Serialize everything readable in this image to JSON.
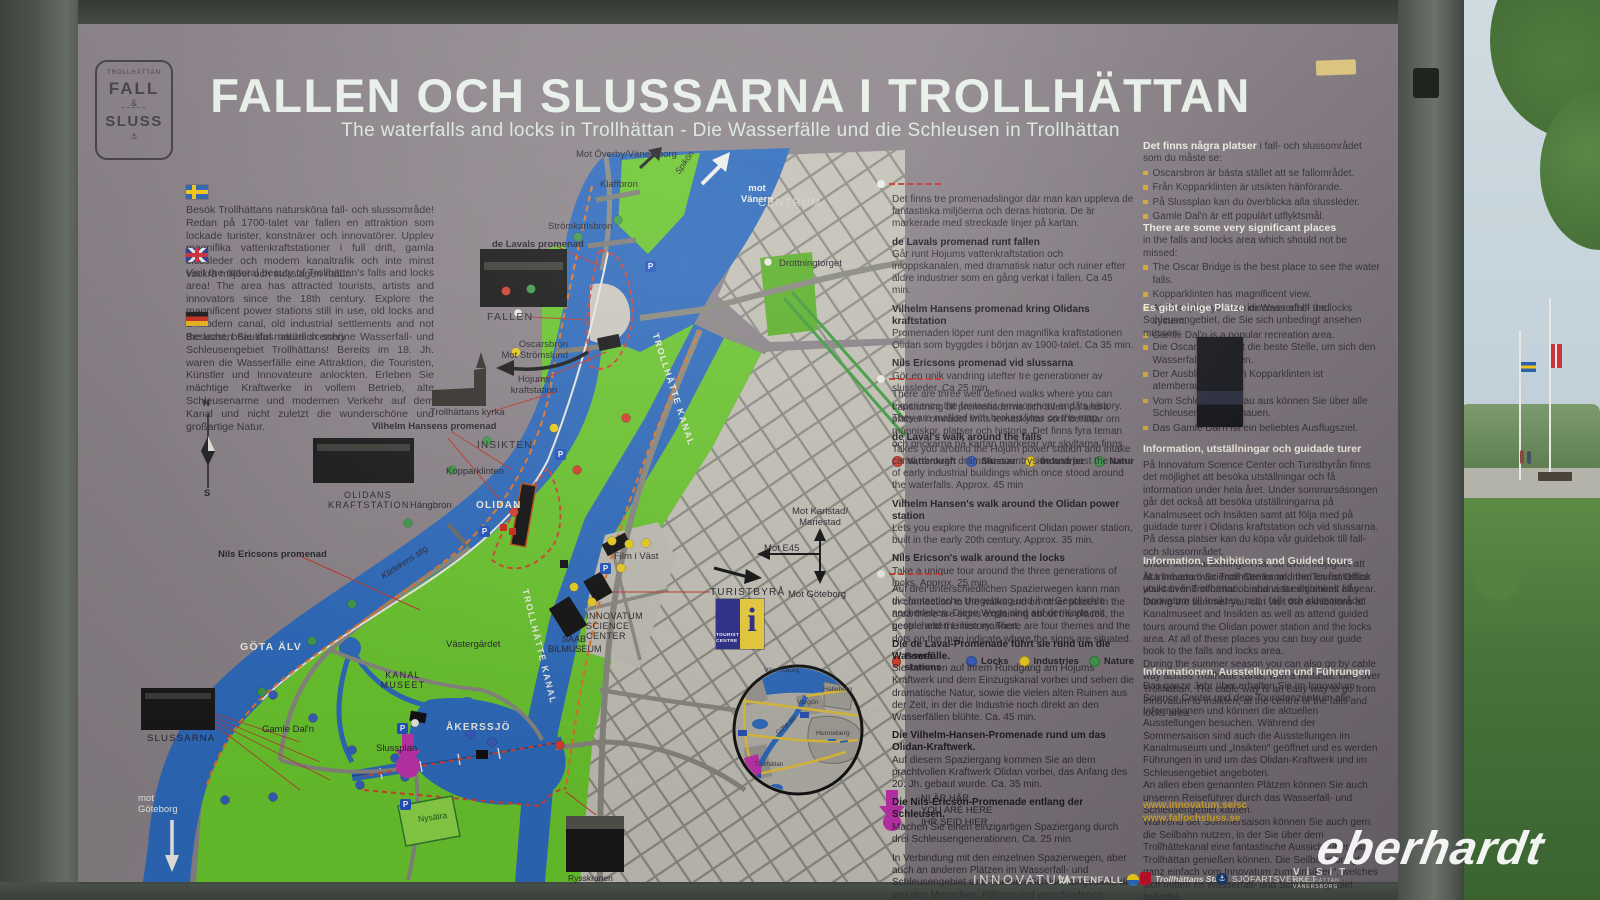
{
  "scene": {
    "watermark": "eberhardt"
  },
  "board": {
    "logo": {
      "arc": "TROLLHÄTTAN",
      "fall": "FALL",
      "amp": "&",
      "sluss": "SLUSS",
      "anchor": "⚓"
    },
    "title": "FALLEN OCH SLUSSARNA I TROLLHÄTTAN",
    "subtitle": "The waterfalls and locks in Trollhättan - Die Wasserfälle und die Schleusen in Trollhättan"
  },
  "intro": {
    "sv": "Besök Trollhättans natursköna fall- och slussområde! Redan på 1700-talet var fallen en attraktion som lockade turister, konstnärer och innovatörer. Upplev magnifika vattenkraftstationer i full drift, gamla slussleder och modern kanaltrafik och inte minst vackra miljöer och storslagen natur.",
    "en": "Visit the natural beauty of Trollhättan's falls and locks area! The area has attracted tourists, artists and innovators since the 18th century. Explore the magnificent power stations still in use, old locks and a modern canal, old industrial settlements and not the least, beautiful natural scenery",
    "de": "Besuchen Sie das natürlich schöne Wasserfall- und Schleusengebiet Trollhättans! Bereits im 18. Jh. waren die Wasserfälle eine Attraktion, die Touristen, Künstler und Innovateure anlockten. Erleben Sie mächtige Kraftwerke in vollem Betrieb, alte Schleusenarme und modernen Verkehr auf dem Kanal und nicht zuletzt die wunderschöne und großartige Natur."
  },
  "walks": {
    "sv": {
      "intro": "Det finns tre promenadslingor där man kan uppleva de fantastiska miljöerna och deras historia. De är markerade med streckade linjer på kartan.",
      "items": [
        {
          "t": "de Lavals promenad runt fallen",
          "b": "Går runt Hojums vattenkraftstation och inloppskanalen, med dramatisk natur och ruiner efter äldre industrier som en gång verkat i fallen. Ca 45 min."
        },
        {
          "t": "Vilhelm Hansens promenad kring Olidans kraftstation",
          "b": "Promenaden löper runt den magnifika kraftstationen Olidan som byggdes i början av 1900-talet. Ca 35 min."
        },
        {
          "t": "Nils Ericsons promenad vid slussarna",
          "b": "Gör en unik vandring utefter tre generationer av slussleder. Ca 25 min."
        }
      ],
      "outro": "I anslutning till promenaderna och även på andra platser i området finns temaskyltar som berättar om människor, platser och historia. Det finns fyra teman och prickarna på kartan markerar var skyltarna finns.",
      "legend": [
        "Vattenkraft",
        "Slussar",
        "Industrier",
        "Natur"
      ]
    },
    "en": {
      "intro": "There are three well defined walks where you can experience the fantastic environment and its history. They are marked with broken lines on the map.",
      "items": [
        {
          "t": "de Laval's walk around the falls",
          "b": "Takes you around the Hojum power station and intake canal, through dramatic countryside and past the ruins of early industrial buildings which once stood around the waterfalls. Approx. 45 min"
        },
        {
          "t": "Vilhelm Hansen's walk around the Olidan power station",
          "b": "Lets you explore the magnificent Olidan power station, built in the early 20th century. Approx. 35 min."
        },
        {
          "t": "Nils Ericson's walk around the locks",
          "b": "Take a unique tour around the three generations of locks. Approx. 25 min."
        }
      ],
      "outro": "In connection to the walks and on other places in the area there are signs explaining about the places, the people and the history. There are four themes and the dots on the map indicate where the signs are situated.",
      "legend": [
        "Power stations",
        "Locks",
        "Industries",
        "Nature"
      ]
    },
    "de": {
      "intro": "Auf drei unterschiedlichen Spazierwegen kann man die fantastische Umgebung und ihre Geschichte nacherleben. Diese Wege sind auf der Karte mit gestrichelten Linien markiert.",
      "items": [
        {
          "t": "Die de Laval-Promenade führt sie rund um die Wasserfälle.",
          "b": "Sie kommen auf ihrem Rundgang am Hojums Kraftwerk und dem Einzugskanal vorbei und sehen die dramatische Natur, sowie die vielen alten Ruinen aus der Zeit, in der die Industrie noch direkt an den Wasserfällen blühte. Ca. 45 min."
        },
        {
          "t": "Die Vilhelm-Hansen-Promenade rund um das Olidan-Kraftwerk.",
          "b": "Auf diesem Spaziergang kommen Sie an dem prachtvollen Kraftwerk Olidan vorbei, das Anfang des 20. Jh. gebaut wurde. Ca. 35 min."
        },
        {
          "t": "Die Nils-Ericson-Promenade entlang der Schleusen.",
          "b": "Machen Sie einen einzigartigen Spaziergang durch drei Schleusengenerationen. Ca. 25 min."
        }
      ],
      "outro": "In Verbindung mit den einzelnen Spazierwegen, aber auch an anderen Plätzen im Wasserfall- und Schleusengebiet sind Themen-Schilder aufgestellt, die von den Menschen, Plätzen und verschiedenen Geschichten berichten. Die vier unterschiedlichen Themen sind auf den Karten mit Punkten markiert.",
      "legend": [
        "Kraftwerk",
        "Schleusen",
        "Industrie",
        "Natur"
      ]
    }
  },
  "places": {
    "sv": {
      "bold": "Det finns några platser",
      "rest": "i fall- och slussområdet som du måste se:",
      "items": [
        "Oscarsbron är bästa stället att se fallområdet.",
        "Från Kopparklinten är utsikten hänförande.",
        "På Slussplan kan du överblicka alla slussleder.",
        "Gamle Dal'n är ett populärt utflyktsmål."
      ]
    },
    "en": {
      "bold": "There are some very significant places",
      "rest": "in the falls and locks area which should not be missed:",
      "items": [
        "The Oscar Bridge is the best place to see the water falls.",
        "Kopparklinten has magnificent view.",
        "At Slussplan you can discover all of the locks system.",
        "Gamle Dal'n is a popular recreation area."
      ]
    },
    "de": {
      "bold": "Es gibt einige Plätze",
      "rest": "im Wasserfall- und Schleusengebiet, die Sie sich unbedingt ansehen müssen:",
      "items": [
        "Die Oscarsbrücke ist die beste Stelle, um sich den Wasserfall anzusehen.",
        "Der Ausblick von den Kopparklinten ist atemberaubend.",
        "Vom Schleusenplateau aus können Sie über alle Schleusenarmen schauen.",
        "Das Gamle Dal'n ist ein beliebtes Ausflugsziel."
      ]
    }
  },
  "info": {
    "sv": {
      "heading": "Information, utställningar och guidade turer",
      "body": "På Innovatum Science Center och Turistbyrån finns det möjlighet att besöka utställningar och få information under hela året. Under sommarsäsongen går det också att besöka utställningarna på Kanalmuseet och Insikten samt att följa med på guidade turer i Olidans kraftstation och vid slussarna. På dessa platser kan du köpa vår guidebok till fall- och slussområdet.\nUnder sommarsäsongen har du även möjlighet att åka linbana över Trollhätte kanal, med en fantastisk utsikt över Trollhättan. Linbana tar dig enkelt från Innovatum till Insikten, mitt i fall- och slussområdet"
    },
    "en": {
      "heading": "Information, Exhibitions and Guided tours",
      "body": "At Innovatum Science Center and the Tourist Office you can find information and visit exhibitions all year. During the summer you can visit the exhibitions at Kanalmuseet and Insikten as well as attend guided tours around the Olidan power station and the locks area. At all of these places you can buy our guide book to the falls and locks area.\nDuring the summer season you can also go by cable way across Trollhätte canal, with a fantastic view over Trollhättan. The cable way is an easy way to go from Innovatum to Insikten, at the centre of the falls and locks area."
    },
    "de": {
      "heading": "Informationen, Ausstellungen und Führungen",
      "body": "Das ganze Jahr über erhalten Sie im Innovatum Science Center und dem Touristenzentrum alle Informationen und können die aktuellen Ausstellungen besuchen. Während der Sommersaison sind auch die Ausstellungen im Kanalmuseum und „Insikten“ geöffnet und es werden Führungen in und um das Olidan-Kraftwerk und im Schleusengebiet angeboten.\nAn allen eben genannten Plätzen können Sie auch unseren Reiseführer durch das Wasserfall- und Schleusengebiet kaufen.\nWährend der Sommersaison können Sie auch gern die Seilbahn nutzen, in der Sie über dem Trollhättekanal eine fantastische Aussicht über ganz Trollhättan genießen können. Die Seilbahn bringt ganz einfach vom Innovatum zum „Insikten“, welches sich mitten im Wasserfall- und Schleusengebiet befindet."
    },
    "links": {
      "l1": "www.innovatum.se/sc",
      "l2": "www.fallochsluss.se"
    }
  },
  "map": {
    "labels": {
      "mot_overby": "Mot Överby/Vänersborg",
      "klaffbron": "Klaffbron",
      "spikon": "Spikön",
      "mot_vanern": "mot\nVänern",
      "centrum": "CENTRUM",
      "stromkarlsbron": "Strömkarlsbron",
      "de_lavals": "de Lavals promenad",
      "drottningtorget": "Drottningtorget",
      "fallen": "FALLEN",
      "oscarsbron": "Oscarsbron\nMot Strömslund",
      "hojums": "Hojums\nkraftstation",
      "kyrka": "Trollhättans kyrka",
      "vilhelm": "Vilhelm Hansens promenad",
      "insikten": "INSIKTEN",
      "kopparklinten": "Kopparklinten",
      "olidans_kraftstation": "OLIDANS\nKRAFTSTATION",
      "hangbron": "Hängbron",
      "olidan": "OLIDAN",
      "nils": "Nils Ericsons promenad",
      "karlekens_stig": "Kärlekens stig",
      "kanal": "TROLLHÄTTE KANAL",
      "gota_alv": "GÖTA ÄLV",
      "vastergardet": "Västergärdet",
      "kanalmuseet": "KANAL\nMUSEET",
      "gamle_daln": "Gamle Dal'n",
      "akerssjo": "ÅKERSSJÖ",
      "slussplan": "Slussplan",
      "slussarna": "SLUSSARNA",
      "mot_goteborg": "mot\nGöteborg",
      "nysatra": "Nysätra",
      "film_i_vast": "Film i Väst",
      "innovatum": "INNOVATUM\nSCIENCE\nCENTER",
      "saab": "SAAB\nBILMUSEUM",
      "turistbyra": "TURISTBYRÅ",
      "rysskranen": "Rysskranen"
    },
    "sign": {
      "karlstad": "Mot Karlstad/\nMariestad",
      "e45": "Mot E45",
      "goteborg": "Mot Göteborg"
    },
    "inset": {
      "vanersborg": "Vänersborg",
      "halleberg": "Halleberg",
      "vargon": "Vargön",
      "gota_alv": "Göta älv",
      "hunneberg": "Hunneberg",
      "trollhattan": "Trollhättan"
    },
    "yah": {
      "l1": "NI ÄR HÄR",
      "l2": "YOU ARE HERE",
      "l3": "IHR SEID HIER"
    },
    "tourist": {
      "t": "TOURIST",
      "c": "CENTRE",
      "i": "i"
    },
    "compass": {
      "n": "N",
      "s": "S"
    },
    "parking": "P"
  },
  "footer": {
    "innovatum": "INNOVATUM",
    "vattenfall": "VATTENFALL",
    "stad": "Trollhättans Stad",
    "sjofartsverket": "SJÖFARTSVERKET",
    "visit_line1": "V i S i T",
    "visit_line2": "TROLLHÄTTAN",
    "visit_line3": "VÄNERSBORG",
    "anchor": "⚓"
  },
  "colors": {
    "water": "#2e6cc0",
    "park": "#6cc92e",
    "dot_red": "#d8402e",
    "dot_blue": "#3a5ec2",
    "dot_yellow": "#f0d020",
    "dot_green": "#3f9d4d",
    "marker_magenta": "#c433b0",
    "gold": "#d8a92c"
  }
}
